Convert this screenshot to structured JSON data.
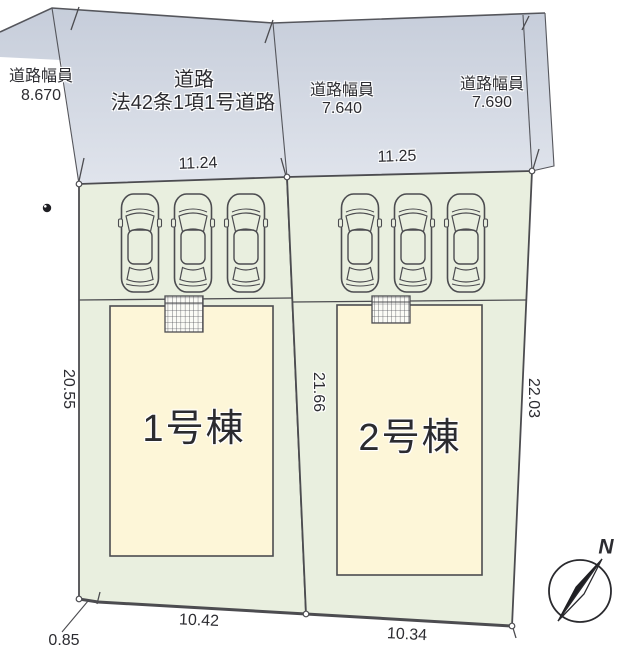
{
  "road": {
    "segment_left": {
      "label": "道路幅員",
      "value": "8.670"
    },
    "name": {
      "line1": "道路",
      "line2": "法42条1項1号道路"
    },
    "segment_mid": {
      "label": "道路幅員",
      "value": "7.640"
    },
    "segment_right": {
      "label": "道路幅員",
      "value": "7.690"
    }
  },
  "dimensions": {
    "frontage_left": "11.24",
    "frontage_right": "11.25",
    "depth_left": "20.55",
    "depth_center": "21.66",
    "depth_right": "22.03",
    "bottom_offset": "0.85",
    "bottom_width_left": "10.42",
    "bottom_width_right": "10.34"
  },
  "buildings": [
    {
      "label": "1号棟"
    },
    {
      "label": "2号棟"
    }
  ],
  "compass": {
    "label": "N"
  },
  "colors": {
    "road_fill_top": "#c6cdda",
    "road_fill_bottom": "#e0e4ec",
    "lot_fill": "#e9efdf",
    "building_fill": "#fdf6d8",
    "line": "#4c4c50",
    "text": "#2c2c31"
  }
}
